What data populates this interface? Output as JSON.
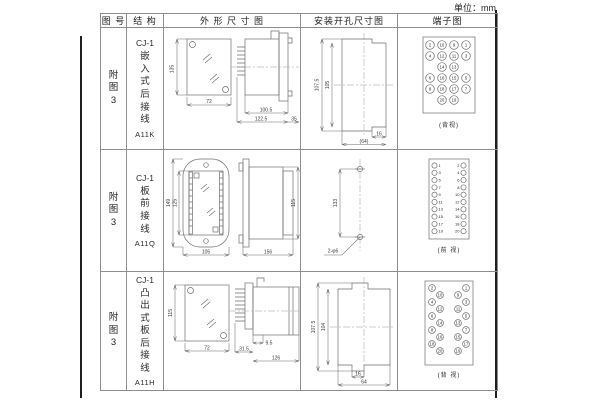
{
  "page": {
    "unit_label": "单位：mm"
  },
  "table": {
    "headers": [
      "图 号",
      "结 构",
      "外 形 尺 寸 图",
      "安装开孔尺寸图",
      "端子图"
    ]
  },
  "rows": [
    {
      "fig_no": "附图3",
      "structure": {
        "model": "CJ-1",
        "desc": "嵌入式后接线",
        "code": "A11K"
      },
      "outline": {
        "height": "135",
        "width": "72",
        "depth_body": "100.5",
        "depth_total": "122.5",
        "flange": "35"
      },
      "install": {
        "outer_h": "107.5",
        "inner_h": "105",
        "notch_w": "16",
        "total_w": "(64)"
      },
      "terminal": {
        "caption": "(背视)",
        "grid": [
          [
            "2",
            "10",
            "9",
            "1"
          ],
          [
            "4",
            "12",
            "11",
            "3"
          ],
          [
            "14",
            "13"
          ],
          [
            "6",
            "16",
            "15",
            "5"
          ],
          [
            "8",
            "18",
            "17",
            "7"
          ],
          [
            "20",
            "19"
          ]
        ]
      }
    },
    {
      "fig_no": "附图3",
      "structure": {
        "model": "CJ-1",
        "desc": "板前接线",
        "code": "A11Q"
      },
      "outline": {
        "outer_h": "149",
        "inner_h": "125",
        "width": "105",
        "length": "156",
        "side_h": "115"
      },
      "install": {
        "pitch": "133",
        "holes": "2-φ6"
      },
      "terminal": {
        "caption": "(前 视)",
        "left": [
          "1",
          "3",
          "5",
          "7",
          "9",
          "11",
          "13",
          "15",
          "17",
          "19"
        ],
        "right": [
          "2",
          "4",
          "6",
          "8",
          "10",
          "12",
          "14",
          "16",
          "18",
          "20"
        ]
      }
    },
    {
      "fig_no": "附图3",
      "structure": {
        "model": "CJ-1",
        "desc": "凸出式板后接线",
        "code": "A11H"
      },
      "outline": {
        "height": "115",
        "width": "72",
        "pin_depth": "31.5",
        "step": "9.5",
        "body_len": "126"
      },
      "install": {
        "outer_h": "107.5",
        "inner_h": "104",
        "notch_w": "16",
        "total_w": "64"
      },
      "terminal": {
        "caption": "(背 视)",
        "left_outer": [
          "2",
          "4",
          "6",
          "8",
          "18"
        ],
        "left_inner": [
          "10",
          "12",
          "14",
          "16",
          "20"
        ],
        "right_inner": [
          "9",
          "11",
          "13",
          "15",
          "19"
        ],
        "right_outer": [
          "1",
          "3",
          "5",
          "7",
          "17"
        ]
      }
    }
  ]
}
